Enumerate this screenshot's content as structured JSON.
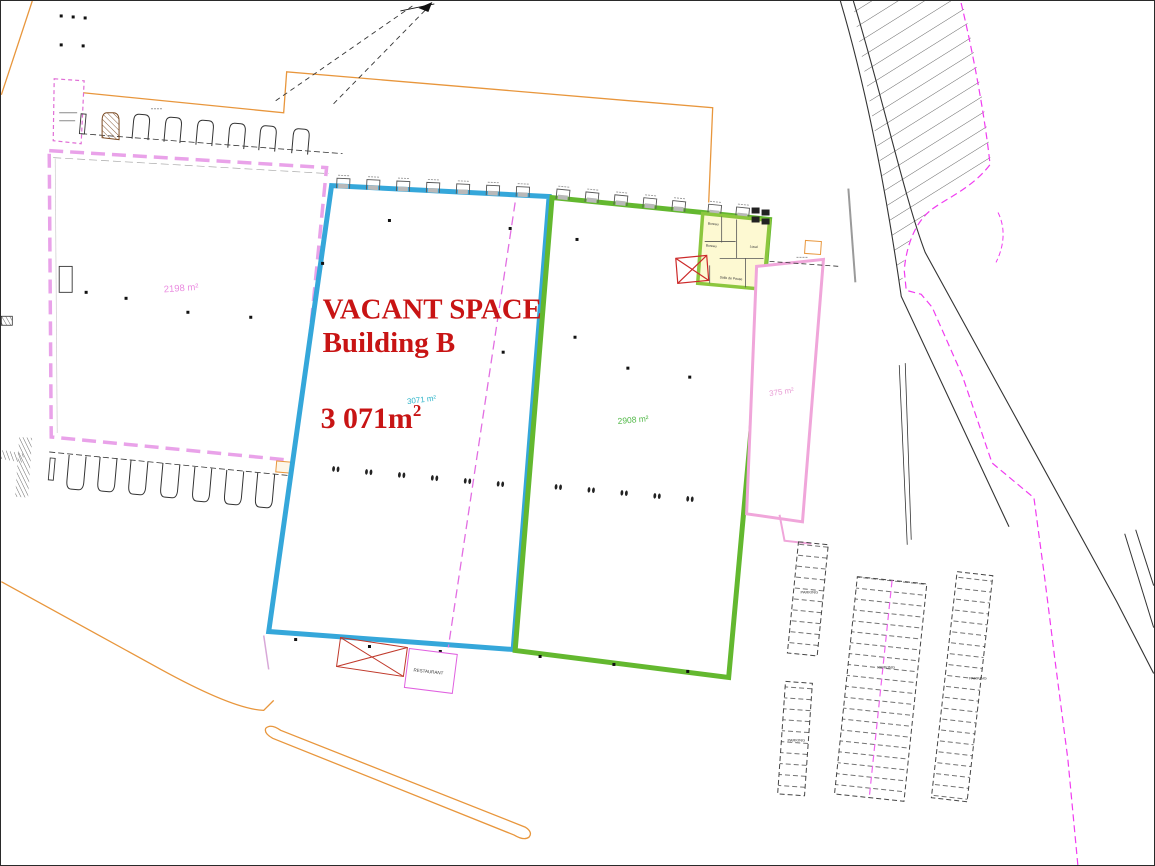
{
  "annotation": {
    "line1": "VACANT SPACE -",
    "line2": "Building B",
    "area_main": "3 071m",
    "area_sup": "2"
  },
  "areas": [
    {
      "id": "building-a",
      "text": "2198 m²",
      "color": "#ea8be0"
    },
    {
      "id": "building-b-small",
      "text": "3071 m²",
      "color": "#2ab3c8"
    },
    {
      "id": "building-c",
      "text": "2908 m²",
      "color": "#52b848"
    },
    {
      "id": "side-strip",
      "text": "375 m²",
      "color": "#e89bd4"
    }
  ],
  "rooms": [
    {
      "text": "Bureau"
    },
    {
      "text": "Bureau"
    },
    {
      "text": "Local"
    },
    {
      "text": "Salle de Pause"
    }
  ],
  "restaurant": {
    "label": "RESTAURANT"
  },
  "parking": {
    "label": "PARKING"
  },
  "colors": {
    "vacant_outline": "#35a7da",
    "neighbor_outline": "#63b82f",
    "pink_outline": "#e9a2e9",
    "annotation_red": "#c81414",
    "site_orange": "#e8963c",
    "boundary_magenta": "#f03cf0",
    "office_fill": "#fdf9d2"
  }
}
